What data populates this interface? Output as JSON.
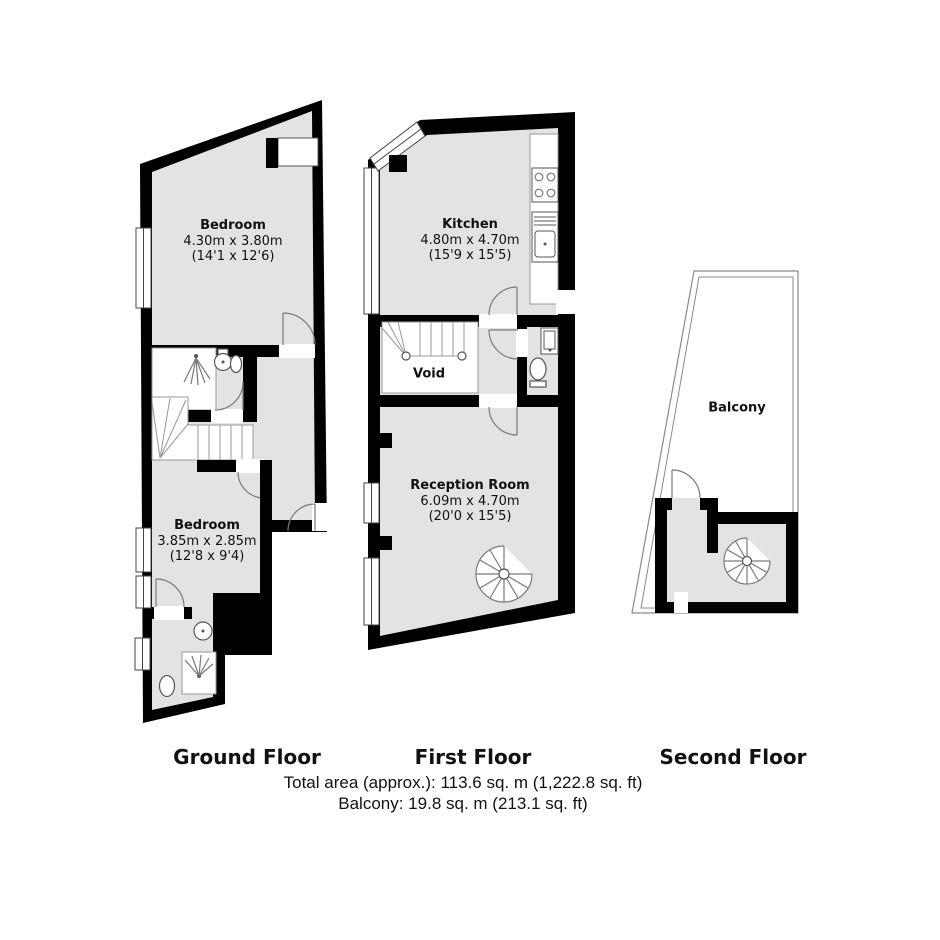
{
  "document": {
    "type": "property-floorplan"
  },
  "floors": [
    {
      "id": "ground",
      "caption": "Ground Floor",
      "rooms": [
        {
          "name": "Bedroom",
          "dim_metric": "4.30m x 3.80m",
          "dim_imperial": "(14'1 x 12'6)"
        },
        {
          "name": "Bedroom",
          "dim_metric": "3.85m x 2.85m",
          "dim_imperial": "(12'8 x 9'4)"
        }
      ]
    },
    {
      "id": "first",
      "caption": "First Floor",
      "rooms": [
        {
          "name": "Kitchen",
          "dim_metric": "4.80m x 4.70m",
          "dim_imperial": "(15'9 x 15'5)"
        },
        {
          "name": "Void",
          "dim_metric": "",
          "dim_imperial": ""
        },
        {
          "name": "Reception Room",
          "dim_metric": "6.09m x 4.70m",
          "dim_imperial": "(20'0 x 15'5)"
        }
      ]
    },
    {
      "id": "second",
      "caption": "Second Floor",
      "rooms": [
        {
          "name": "Balcony",
          "dim_metric": "",
          "dim_imperial": ""
        }
      ]
    }
  ],
  "footer": {
    "total_area": "Total area (approx.): 113.6 sq. m (1,222.8 sq. ft)",
    "balcony_area": "Balcony: 19.8 sq. m (213.1 sq. ft)"
  },
  "colors": {
    "wall": "#000000",
    "floor_fill": "#e3e3e3",
    "line": "#7a7a7a",
    "background": "#ffffff",
    "text": "#111111"
  }
}
